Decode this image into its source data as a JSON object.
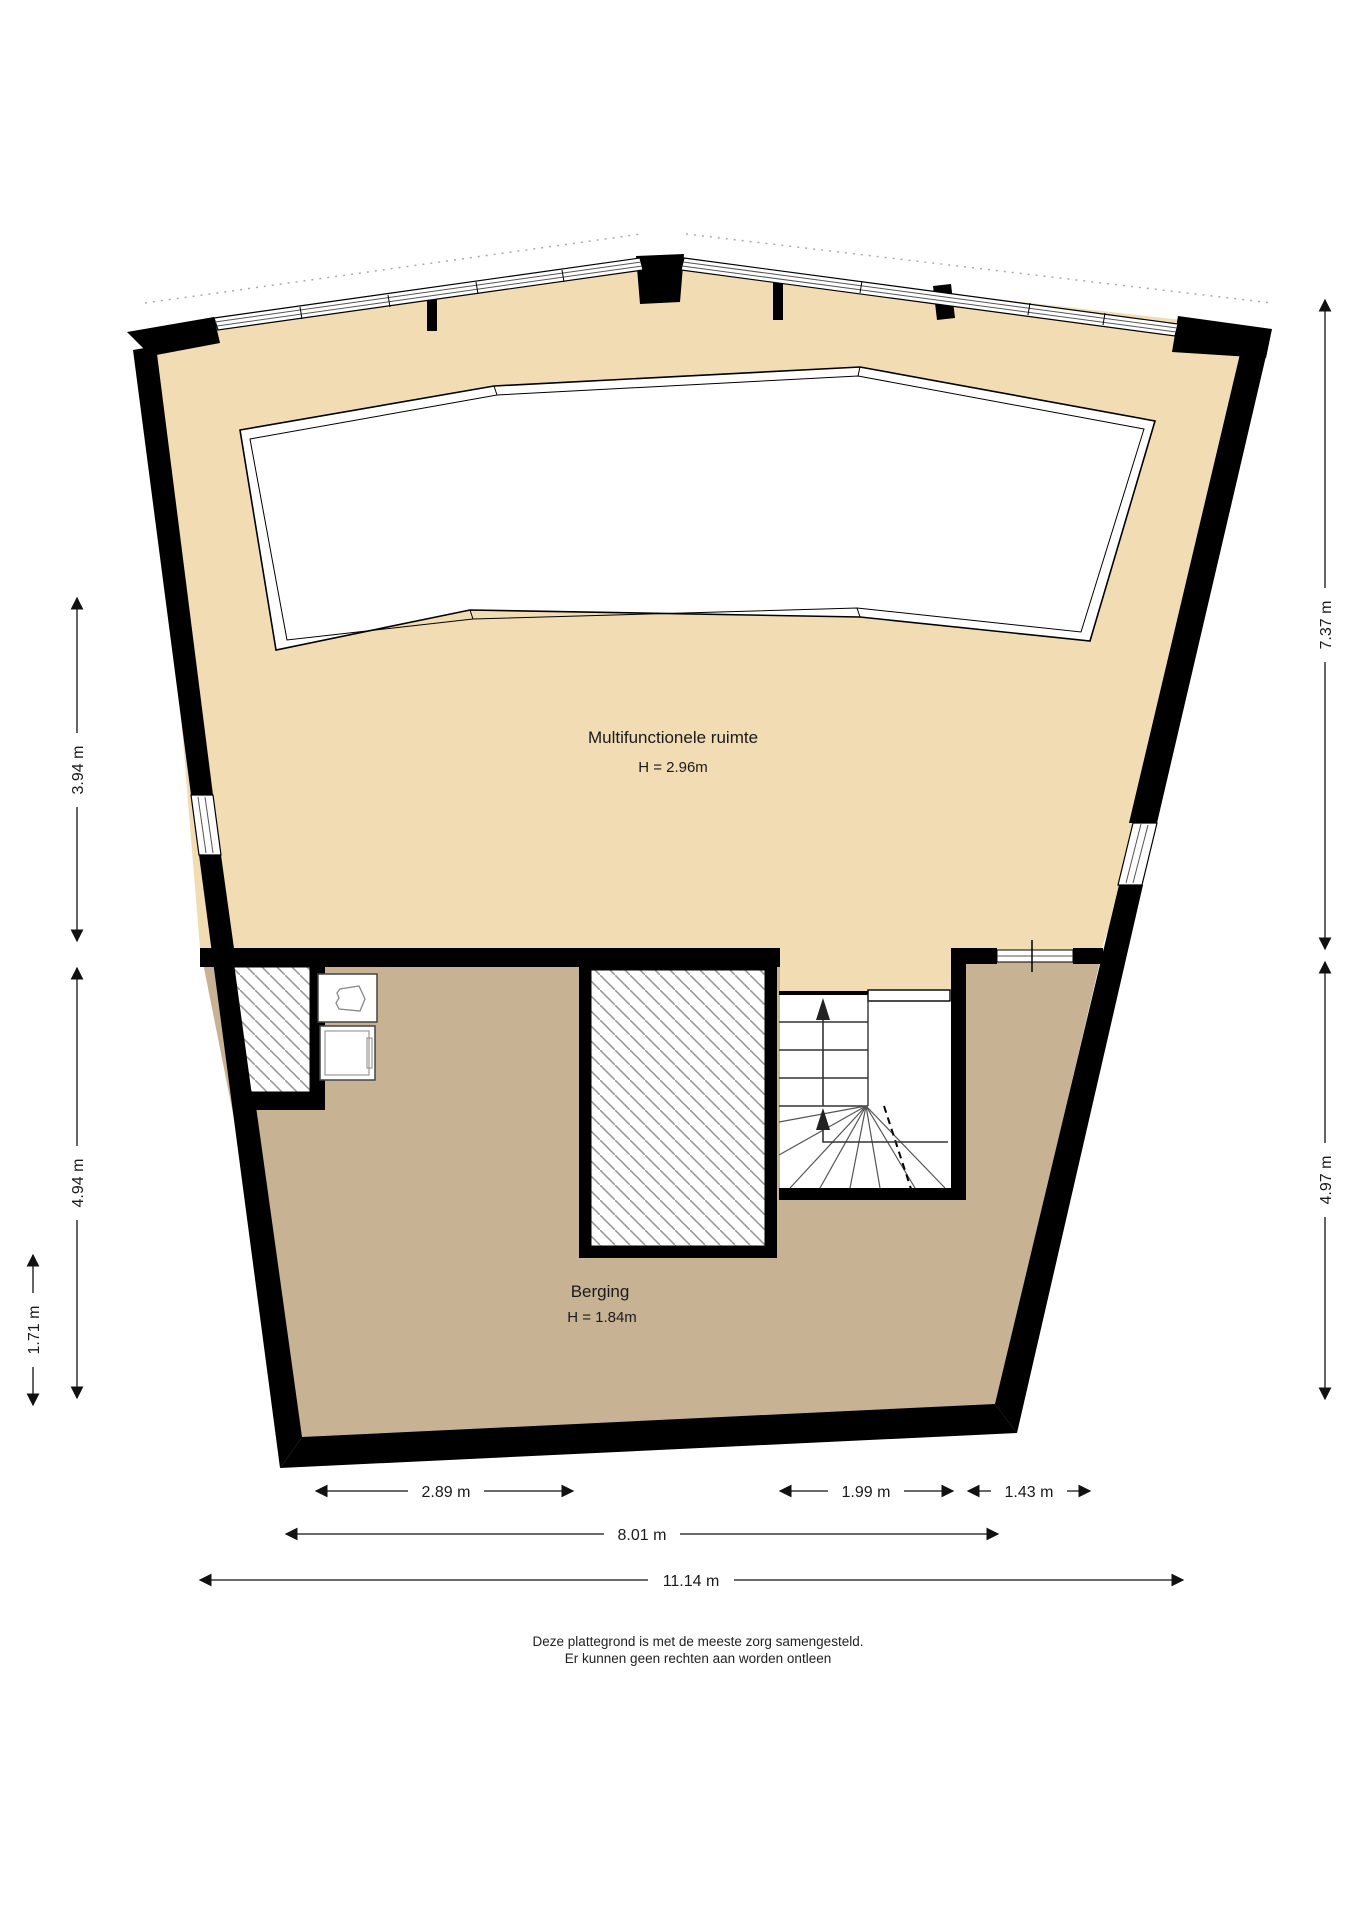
{
  "plan_title": "plattegrond",
  "rooms": {
    "multifunctional": {
      "name": "Multifunctionele ruimte",
      "height": "H = 2.96m"
    },
    "storage": {
      "name": "Berging",
      "height": "H = 1.84m"
    }
  },
  "dimensions": {
    "left": [
      "3.94 m",
      "4.94 m",
      "1.71 m"
    ],
    "right": [
      "7.37 m",
      "4.97 m"
    ],
    "bottom": [
      "2.89 m",
      "1.99 m",
      "1.43 m",
      "8.01 m",
      "11.14 m"
    ]
  },
  "footer": {
    "line1": "Deze plattegrond is met de meeste zorg samengesteld.",
    "line2": "Er kunnen geen rechten aan worden ontleen"
  },
  "colors": {
    "upper_floor": "#f2dcb3",
    "lower_floor": "#c8b294",
    "wall": "#000000",
    "hatch_line": "#999999",
    "glazing": "#555555"
  }
}
